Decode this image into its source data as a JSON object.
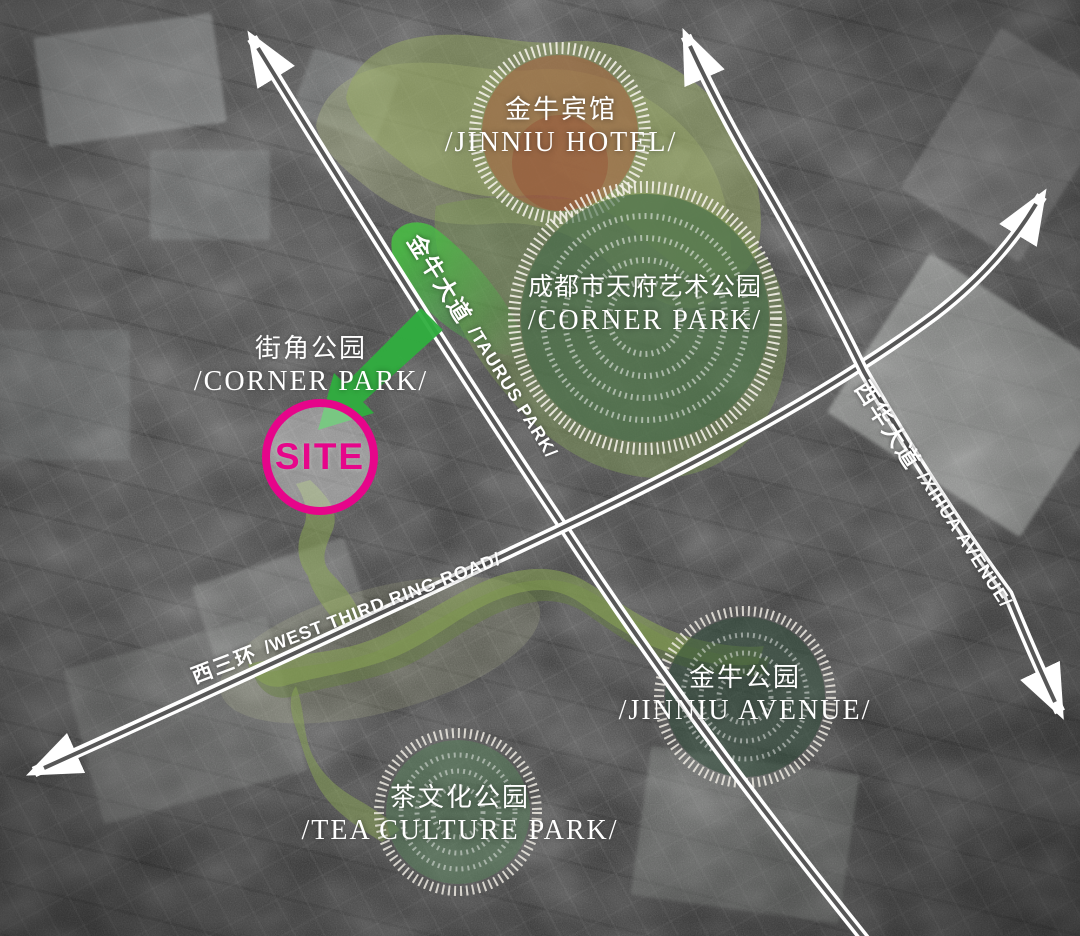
{
  "map": {
    "site": {
      "label": "SITE"
    },
    "locations": {
      "jinniu_hotel": {
        "zh": "金牛宾馆",
        "en": "/JINNIU HOTEL/"
      },
      "tianfu_art_park": {
        "zh": "成都市天府艺术公园",
        "en": "/CORNER PARK/"
      },
      "corner_park": {
        "zh": "街角公园",
        "en": "/CORNER PARK/"
      },
      "jinniu_park": {
        "zh": "金牛公园",
        "en": "/JINNIU AVENUE/"
      },
      "tea_culture_park": {
        "zh": "茶文化公园",
        "en": "/TEA CULTURE PARK/"
      }
    },
    "roads": {
      "taurus_avenue": {
        "zh": "金牛大道",
        "en": "/TAURUS PARK/"
      },
      "xihua_avenue": {
        "zh": "西华大道",
        "en": "/XIHUA AVENUE/"
      },
      "west_third_ring_road": {
        "zh": "西三环",
        "en": "/WEST THIRD RING ROAD/"
      }
    },
    "colors": {
      "site_magenta": "#e6058a",
      "arrow_green": "#2fae3e",
      "greenway_olive": "#8aa554",
      "park_green": "#466c4a",
      "hotel_rust": "#a55f3c",
      "road_white": "#ffffff"
    }
  }
}
